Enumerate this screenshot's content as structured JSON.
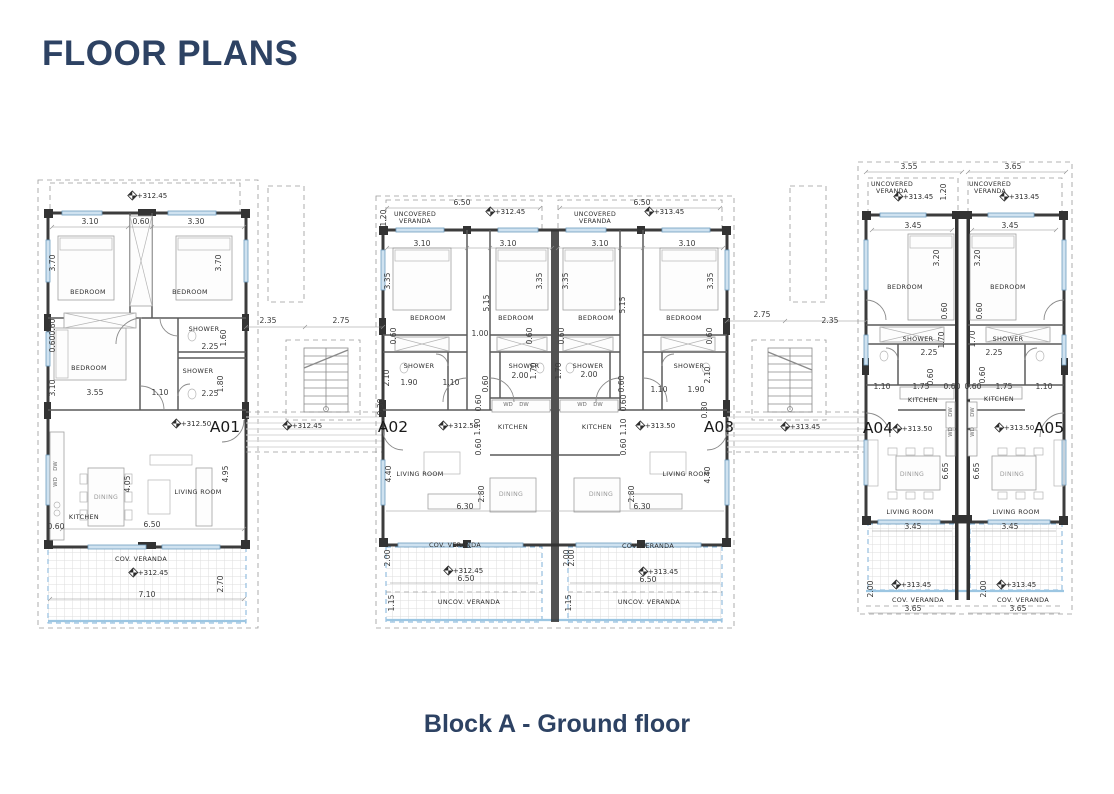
{
  "page": {
    "title": "FLOOR PLANS",
    "caption": "Block A - Ground floor",
    "accent_color": "#2d4263"
  },
  "drawing": {
    "units": [
      "A01",
      "A02",
      "A03",
      "A04",
      "A05"
    ],
    "annotations": [
      {
        "t": "+312.45",
        "x": 152,
        "y": 198,
        "k": "elev"
      },
      {
        "t": "3.10",
        "x": 90,
        "y": 224,
        "k": "dim"
      },
      {
        "t": "0.60",
        "x": 141,
        "y": 224,
        "k": "dim"
      },
      {
        "t": "3.30",
        "x": 196,
        "y": 224,
        "k": "dim"
      },
      {
        "t": "3.70",
        "x": 55,
        "y": 263,
        "k": "dim",
        "r": -90
      },
      {
        "t": "3.70",
        "x": 221,
        "y": 263,
        "k": "dim",
        "r": -90
      },
      {
        "t": "BEDROOM",
        "x": 88,
        "y": 294,
        "k": "room"
      },
      {
        "t": "BEDROOM",
        "x": 190,
        "y": 294,
        "k": "room"
      },
      {
        "t": "0.60",
        "x": 55,
        "y": 327,
        "k": "dim",
        "r": -90
      },
      {
        "t": "0.60",
        "x": 55,
        "y": 344,
        "k": "dim",
        "r": -90
      },
      {
        "t": "SHOWER",
        "x": 204,
        "y": 331,
        "k": "room"
      },
      {
        "t": "2.25",
        "x": 210,
        "y": 349,
        "k": "dim"
      },
      {
        "t": "1.60",
        "x": 226,
        "y": 338,
        "k": "dim",
        "r": -90
      },
      {
        "t": "BEDROOM",
        "x": 89,
        "y": 370,
        "k": "room"
      },
      {
        "t": "SHOWER",
        "x": 198,
        "y": 373,
        "k": "room"
      },
      {
        "t": "1.10",
        "x": 160,
        "y": 395,
        "k": "dim"
      },
      {
        "t": "2.25",
        "x": 210,
        "y": 396,
        "k": "dim"
      },
      {
        "t": "1.80",
        "x": 223,
        "y": 384,
        "k": "dim",
        "r": -90
      },
      {
        "t": "3.10",
        "x": 55,
        "y": 388,
        "k": "dim",
        "r": -90
      },
      {
        "t": "3.55",
        "x": 95,
        "y": 395,
        "k": "dim"
      },
      {
        "t": "+312.50",
        "x": 196,
        "y": 426,
        "k": "elev"
      },
      {
        "t": "A01",
        "x": 225,
        "y": 432,
        "k": "unit"
      },
      {
        "t": "DW",
        "x": 57,
        "y": 466,
        "k": "tiny",
        "r": -90
      },
      {
        "t": "WD",
        "x": 57,
        "y": 482,
        "k": "tiny",
        "r": -90
      },
      {
        "t": "4.05",
        "x": 130,
        "y": 484,
        "k": "dim",
        "r": -90
      },
      {
        "t": "DINING",
        "x": 106,
        "y": 499,
        "k": "roomlt"
      },
      {
        "t": "KITCHEN",
        "x": 84,
        "y": 519,
        "k": "room"
      },
      {
        "t": "LIVING ROOM",
        "x": 198,
        "y": 494,
        "k": "room"
      },
      {
        "t": "4.95",
        "x": 228,
        "y": 474,
        "k": "dim",
        "r": -90
      },
      {
        "t": "0.60",
        "x": 56,
        "y": 529,
        "k": "dim"
      },
      {
        "t": "6.50",
        "x": 152,
        "y": 527,
        "k": "dim"
      },
      {
        "t": "COV. VERANDA",
        "x": 141,
        "y": 561,
        "k": "room"
      },
      {
        "t": "+312.45",
        "x": 153,
        "y": 575,
        "k": "elev"
      },
      {
        "t": "7.10",
        "x": 147,
        "y": 597,
        "k": "dim"
      },
      {
        "t": "2.70",
        "x": 223,
        "y": 584,
        "k": "dim",
        "r": -90
      },
      {
        "t": "2.35",
        "x": 268,
        "y": 323,
        "k": "dim"
      },
      {
        "t": "2.75",
        "x": 341,
        "y": 323,
        "k": "dim"
      },
      {
        "t": "+312.45",
        "x": 307,
        "y": 428,
        "k": "elev"
      },
      {
        "t": "6.50",
        "x": 462,
        "y": 205,
        "k": "dim"
      },
      {
        "t": "UNCOVERED\nVERANDA",
        "x": 415,
        "y": 216,
        "k": "room2"
      },
      {
        "t": "+312.45",
        "x": 510,
        "y": 214,
        "k": "elev"
      },
      {
        "t": "1.20",
        "x": 386,
        "y": 218,
        "k": "dim",
        "r": -90
      },
      {
        "t": "3.10",
        "x": 422,
        "y": 246,
        "k": "dim"
      },
      {
        "t": "3.10",
        "x": 508,
        "y": 246,
        "k": "dim"
      },
      {
        "t": "3.35",
        "x": 390,
        "y": 281,
        "k": "dim",
        "r": -90
      },
      {
        "t": "3.35",
        "x": 542,
        "y": 281,
        "k": "dim",
        "r": -90
      },
      {
        "t": "5.15",
        "x": 489,
        "y": 303,
        "k": "dim",
        "r": -90
      },
      {
        "t": "BEDROOM",
        "x": 428,
        "y": 320,
        "k": "room"
      },
      {
        "t": "BEDROOM",
        "x": 516,
        "y": 320,
        "k": "room"
      },
      {
        "t": "0.60",
        "x": 396,
        "y": 336,
        "k": "dim",
        "r": -90
      },
      {
        "t": "1.00",
        "x": 480,
        "y": 336,
        "k": "dim"
      },
      {
        "t": "0.60",
        "x": 532,
        "y": 336,
        "k": "dim",
        "r": -90
      },
      {
        "t": "SHOWER",
        "x": 419,
        "y": 368,
        "k": "room"
      },
      {
        "t": "SHOWER",
        "x": 524,
        "y": 368,
        "k": "room"
      },
      {
        "t": "2.10",
        "x": 389,
        "y": 378,
        "k": "dim",
        "r": -90
      },
      {
        "t": "1.90",
        "x": 409,
        "y": 385,
        "k": "dim"
      },
      {
        "t": "1.10",
        "x": 451,
        "y": 385,
        "k": "dim"
      },
      {
        "t": "0.60",
        "x": 488,
        "y": 384,
        "k": "dim",
        "r": -90
      },
      {
        "t": "2.00",
        "x": 520,
        "y": 378,
        "k": "dim"
      },
      {
        "t": "1.70",
        "x": 536,
        "y": 371,
        "k": "dim",
        "r": -90
      },
      {
        "t": "0.30",
        "x": 383,
        "y": 407,
        "k": "dim",
        "r": -90
      },
      {
        "t": "0.60",
        "x": 481,
        "y": 403,
        "k": "dim",
        "r": -90
      },
      {
        "t": "WD",
        "x": 508,
        "y": 406,
        "k": "tiny"
      },
      {
        "t": "DW",
        "x": 524,
        "y": 406,
        "k": "tiny"
      },
      {
        "t": "A02",
        "x": 393,
        "y": 432,
        "k": "unit"
      },
      {
        "t": "+312.50",
        "x": 463,
        "y": 428,
        "k": "elev"
      },
      {
        "t": "1.10",
        "x": 480,
        "y": 427,
        "k": "dim",
        "r": -90
      },
      {
        "t": "KITCHEN",
        "x": 513,
        "y": 429,
        "k": "room"
      },
      {
        "t": "0.60",
        "x": 481,
        "y": 447,
        "k": "dim",
        "r": -90
      },
      {
        "t": "4.40",
        "x": 391,
        "y": 474,
        "k": "dim",
        "r": -90
      },
      {
        "t": "LIVING ROOM",
        "x": 420,
        "y": 476,
        "k": "room"
      },
      {
        "t": "2.80",
        "x": 484,
        "y": 494,
        "k": "dim",
        "r": -90
      },
      {
        "t": "DINING",
        "x": 511,
        "y": 496,
        "k": "roomlt"
      },
      {
        "t": "6.30",
        "x": 465,
        "y": 509,
        "k": "dim"
      },
      {
        "t": "COV. VERANDA",
        "x": 455,
        "y": 547,
        "k": "room"
      },
      {
        "t": "2.00",
        "x": 390,
        "y": 558,
        "k": "dim",
        "r": -90
      },
      {
        "t": "+312.45",
        "x": 468,
        "y": 573,
        "k": "elev"
      },
      {
        "t": "6.50",
        "x": 466,
        "y": 581,
        "k": "dim"
      },
      {
        "t": "2.00",
        "x": 569,
        "y": 558,
        "k": "dim",
        "r": -90
      },
      {
        "t": "1.15",
        "x": 394,
        "y": 603,
        "k": "dim",
        "r": -90
      },
      {
        "t": "UNCOV. VERANDA",
        "x": 469,
        "y": 604,
        "k": "room"
      },
      {
        "t": "1.15",
        "x": 571,
        "y": 603,
        "k": "dim",
        "r": -90
      },
      {
        "t": "6.50",
        "x": 642,
        "y": 205,
        "k": "dim"
      },
      {
        "t": "UNCOVERED\nVERANDA",
        "x": 595,
        "y": 216,
        "k": "room2"
      },
      {
        "t": "+313.45",
        "x": 669,
        "y": 214,
        "k": "elev"
      },
      {
        "t": "3.10",
        "x": 600,
        "y": 246,
        "k": "dim"
      },
      {
        "t": "3.10",
        "x": 687,
        "y": 246,
        "k": "dim"
      },
      {
        "t": "3.35",
        "x": 568,
        "y": 281,
        "k": "dim",
        "r": -90
      },
      {
        "t": "5.15",
        "x": 625,
        "y": 305,
        "k": "dim",
        "r": -90
      },
      {
        "t": "3.35",
        "x": 713,
        "y": 281,
        "k": "dim",
        "r": -90
      },
      {
        "t": "BEDROOM",
        "x": 596,
        "y": 320,
        "k": "room"
      },
      {
        "t": "BEDROOM",
        "x": 684,
        "y": 320,
        "k": "room"
      },
      {
        "t": "0.60",
        "x": 564,
        "y": 336,
        "k": "dim",
        "r": -90
      },
      {
        "t": "0.60",
        "x": 712,
        "y": 336,
        "k": "dim",
        "r": -90
      },
      {
        "t": "SHOWER",
        "x": 588,
        "y": 368,
        "k": "room"
      },
      {
        "t": "2.00",
        "x": 589,
        "y": 377,
        "k": "dim"
      },
      {
        "t": "1.70",
        "x": 561,
        "y": 371,
        "k": "dim",
        "r": -90
      },
      {
        "t": "SHOWER",
        "x": 689,
        "y": 368,
        "k": "room"
      },
      {
        "t": "2.10",
        "x": 710,
        "y": 375,
        "k": "dim",
        "r": -90
      },
      {
        "t": "1.10",
        "x": 659,
        "y": 392,
        "k": "dim"
      },
      {
        "t": "1.90",
        "x": 696,
        "y": 392,
        "k": "dim"
      },
      {
        "t": "0.60",
        "x": 624,
        "y": 384,
        "k": "dim",
        "r": -90
      },
      {
        "t": "WD",
        "x": 582,
        "y": 406,
        "k": "tiny"
      },
      {
        "t": "DW",
        "x": 598,
        "y": 406,
        "k": "tiny"
      },
      {
        "t": "0.60",
        "x": 626,
        "y": 403,
        "k": "dim",
        "r": -90
      },
      {
        "t": "KITCHEN",
        "x": 597,
        "y": 429,
        "k": "room"
      },
      {
        "t": "1.10",
        "x": 626,
        "y": 427,
        "k": "dim",
        "r": -90
      },
      {
        "t": "+313.50",
        "x": 660,
        "y": 428,
        "k": "elev"
      },
      {
        "t": "A03",
        "x": 719,
        "y": 432,
        "k": "unit"
      },
      {
        "t": "0.30",
        "x": 707,
        "y": 410,
        "k": "dim",
        "r": -90
      },
      {
        "t": "0.60",
        "x": 626,
        "y": 447,
        "k": "dim",
        "r": -90
      },
      {
        "t": "DINING",
        "x": 601,
        "y": 496,
        "k": "roomlt"
      },
      {
        "t": "2.80",
        "x": 634,
        "y": 494,
        "k": "dim",
        "r": -90
      },
      {
        "t": "6.30",
        "x": 642,
        "y": 509,
        "k": "dim"
      },
      {
        "t": "LIVING ROOM",
        "x": 686,
        "y": 476,
        "k": "room"
      },
      {
        "t": "4.40",
        "x": 710,
        "y": 475,
        "k": "dim",
        "r": -90
      },
      {
        "t": "COV. VERANDA",
        "x": 648,
        "y": 548,
        "k": "room"
      },
      {
        "t": "2.00",
        "x": 574,
        "y": 558,
        "k": "dim",
        "r": -90
      },
      {
        "t": "+313.45",
        "x": 663,
        "y": 574,
        "k": "elev"
      },
      {
        "t": "6.50",
        "x": 648,
        "y": 582,
        "k": "dim"
      },
      {
        "t": "UNCOV. VERANDA",
        "x": 649,
        "y": 604,
        "k": "room"
      },
      {
        "t": "2.75",
        "x": 762,
        "y": 317,
        "k": "dim"
      },
      {
        "t": "2.35",
        "x": 830,
        "y": 323,
        "k": "dim"
      },
      {
        "t": "+313.45",
        "x": 805,
        "y": 429,
        "k": "elev"
      },
      {
        "t": "3.55",
        "x": 909,
        "y": 169,
        "k": "dim"
      },
      {
        "t": "3.65",
        "x": 1013,
        "y": 169,
        "k": "dim"
      },
      {
        "t": "UNCOVERED\nVERANDA",
        "x": 892,
        "y": 186,
        "k": "room2"
      },
      {
        "t": "+313.45",
        "x": 918,
        "y": 199,
        "k": "elev"
      },
      {
        "t": "1.20",
        "x": 946,
        "y": 192,
        "k": "dim",
        "r": -90
      },
      {
        "t": "UNCOVERED\nVERANDA",
        "x": 990,
        "y": 186,
        "k": "room2"
      },
      {
        "t": "+313.45",
        "x": 1024,
        "y": 199,
        "k": "elev"
      },
      {
        "t": "3.45",
        "x": 913,
        "y": 228,
        "k": "dim"
      },
      {
        "t": "3.45",
        "x": 1010,
        "y": 228,
        "k": "dim"
      },
      {
        "t": "3.20",
        "x": 939,
        "y": 258,
        "k": "dim",
        "r": -90
      },
      {
        "t": "3.20",
        "x": 980,
        "y": 258,
        "k": "dim",
        "r": -90
      },
      {
        "t": "BEDROOM",
        "x": 905,
        "y": 289,
        "k": "room"
      },
      {
        "t": "BEDROOM",
        "x": 1008,
        "y": 289,
        "k": "room"
      },
      {
        "t": "0.60",
        "x": 947,
        "y": 311,
        "k": "dim",
        "r": -90
      },
      {
        "t": "0.60",
        "x": 982,
        "y": 311,
        "k": "dim",
        "r": -90
      },
      {
        "t": "SHOWER",
        "x": 918,
        "y": 341,
        "k": "room"
      },
      {
        "t": "1.70",
        "x": 944,
        "y": 340,
        "k": "dim",
        "r": -90
      },
      {
        "t": "1.70",
        "x": 975,
        "y": 339,
        "k": "dim",
        "r": -90
      },
      {
        "t": "SHOWER",
        "x": 1008,
        "y": 341,
        "k": "room"
      },
      {
        "t": "2.25",
        "x": 929,
        "y": 355,
        "k": "dim"
      },
      {
        "t": "2.25",
        "x": 994,
        "y": 355,
        "k": "dim"
      },
      {
        "t": "0.60",
        "x": 933,
        "y": 377,
        "k": "dim",
        "r": -90
      },
      {
        "t": "0.60",
        "x": 985,
        "y": 375,
        "k": "dim",
        "r": -90
      },
      {
        "t": "1.10",
        "x": 882,
        "y": 389,
        "k": "dim"
      },
      {
        "t": "1.75",
        "x": 921,
        "y": 389,
        "k": "dim"
      },
      {
        "t": "0.60",
        "x": 952,
        "y": 389,
        "k": "dim"
      },
      {
        "t": "0.60",
        "x": 973,
        "y": 389,
        "k": "dim"
      },
      {
        "t": "1.75",
        "x": 1004,
        "y": 389,
        "k": "dim"
      },
      {
        "t": "1.10",
        "x": 1044,
        "y": 389,
        "k": "dim"
      },
      {
        "t": "KITCHEN",
        "x": 923,
        "y": 402,
        "k": "room"
      },
      {
        "t": "KITCHEN",
        "x": 999,
        "y": 401,
        "k": "room"
      },
      {
        "t": "A04",
        "x": 878,
        "y": 433,
        "k": "unit"
      },
      {
        "t": "+313.50",
        "x": 917,
        "y": 431,
        "k": "elev"
      },
      {
        "t": "+313.50",
        "x": 1019,
        "y": 430,
        "k": "elev"
      },
      {
        "t": "A05",
        "x": 1049,
        "y": 433,
        "k": "unit"
      },
      {
        "t": "DW",
        "x": 952,
        "y": 412,
        "k": "tiny",
        "r": -90
      },
      {
        "t": "WD",
        "x": 952,
        "y": 432,
        "k": "tiny",
        "r": -90
      },
      {
        "t": "DW",
        "x": 974,
        "y": 412,
        "k": "tiny",
        "r": -90
      },
      {
        "t": "WD",
        "x": 974,
        "y": 432,
        "k": "tiny",
        "r": -90
      },
      {
        "t": "DINING",
        "x": 912,
        "y": 476,
        "k": "roomlt"
      },
      {
        "t": "6.65",
        "x": 948,
        "y": 471,
        "k": "dim",
        "r": -90
      },
      {
        "t": "6.65",
        "x": 979,
        "y": 471,
        "k": "dim",
        "r": -90
      },
      {
        "t": "DINING",
        "x": 1012,
        "y": 476,
        "k": "roomlt"
      },
      {
        "t": "LIVING ROOM",
        "x": 910,
        "y": 514,
        "k": "room"
      },
      {
        "t": "3.45",
        "x": 913,
        "y": 529,
        "k": "dim"
      },
      {
        "t": "LIVING ROOM",
        "x": 1016,
        "y": 514,
        "k": "room"
      },
      {
        "t": "3.45",
        "x": 1010,
        "y": 529,
        "k": "dim"
      },
      {
        "t": "2.00",
        "x": 873,
        "y": 589,
        "k": "dim",
        "r": -90
      },
      {
        "t": "+313.45",
        "x": 916,
        "y": 587,
        "k": "elev"
      },
      {
        "t": "COV. VERANDA",
        "x": 918,
        "y": 602,
        "k": "room"
      },
      {
        "t": "3.65",
        "x": 913,
        "y": 611,
        "k": "dim"
      },
      {
        "t": "2.00",
        "x": 986,
        "y": 589,
        "k": "dim",
        "r": -90
      },
      {
        "t": "+313.45",
        "x": 1021,
        "y": 587,
        "k": "elev"
      },
      {
        "t": "COV. VERANDA",
        "x": 1023,
        "y": 602,
        "k": "room"
      },
      {
        "t": "3.65",
        "x": 1018,
        "y": 611,
        "k": "dim"
      }
    ]
  }
}
